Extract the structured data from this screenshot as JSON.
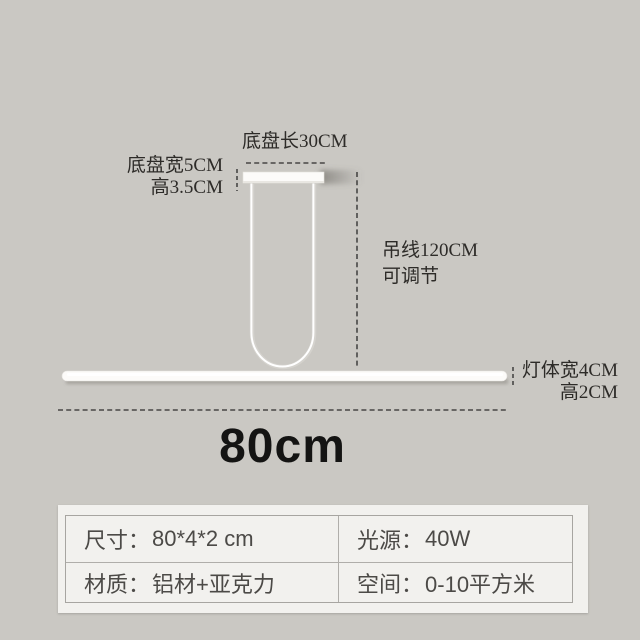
{
  "diagram": {
    "base_length_label": "底盘长30CM",
    "base_width_label": "底盘宽5CM",
    "base_height_label": "高3.5CM",
    "wire_length_label": "吊线120CM",
    "wire_adjust_label": "可调节",
    "body_width_label": "灯体宽4CM",
    "body_height_label": "高2CM",
    "total_length_label": "80cm"
  },
  "spec_panel": {
    "rows": [
      {
        "cells": [
          {
            "label": "尺寸：",
            "value": "80*4*2 cm"
          },
          {
            "label": "光源：",
            "value": "40W"
          }
        ]
      },
      {
        "cells": [
          {
            "label": "材质：",
            "value": "铝材+亚克力"
          },
          {
            "label": "空间：",
            "value": "0-10平方米"
          }
        ]
      }
    ]
  },
  "colors": {
    "background": "#cac8c3",
    "panel": "#f2f1ee",
    "dash": "#474645",
    "annotation_text": "#2d2b28",
    "lamp_white": "#fcfbf9"
  }
}
